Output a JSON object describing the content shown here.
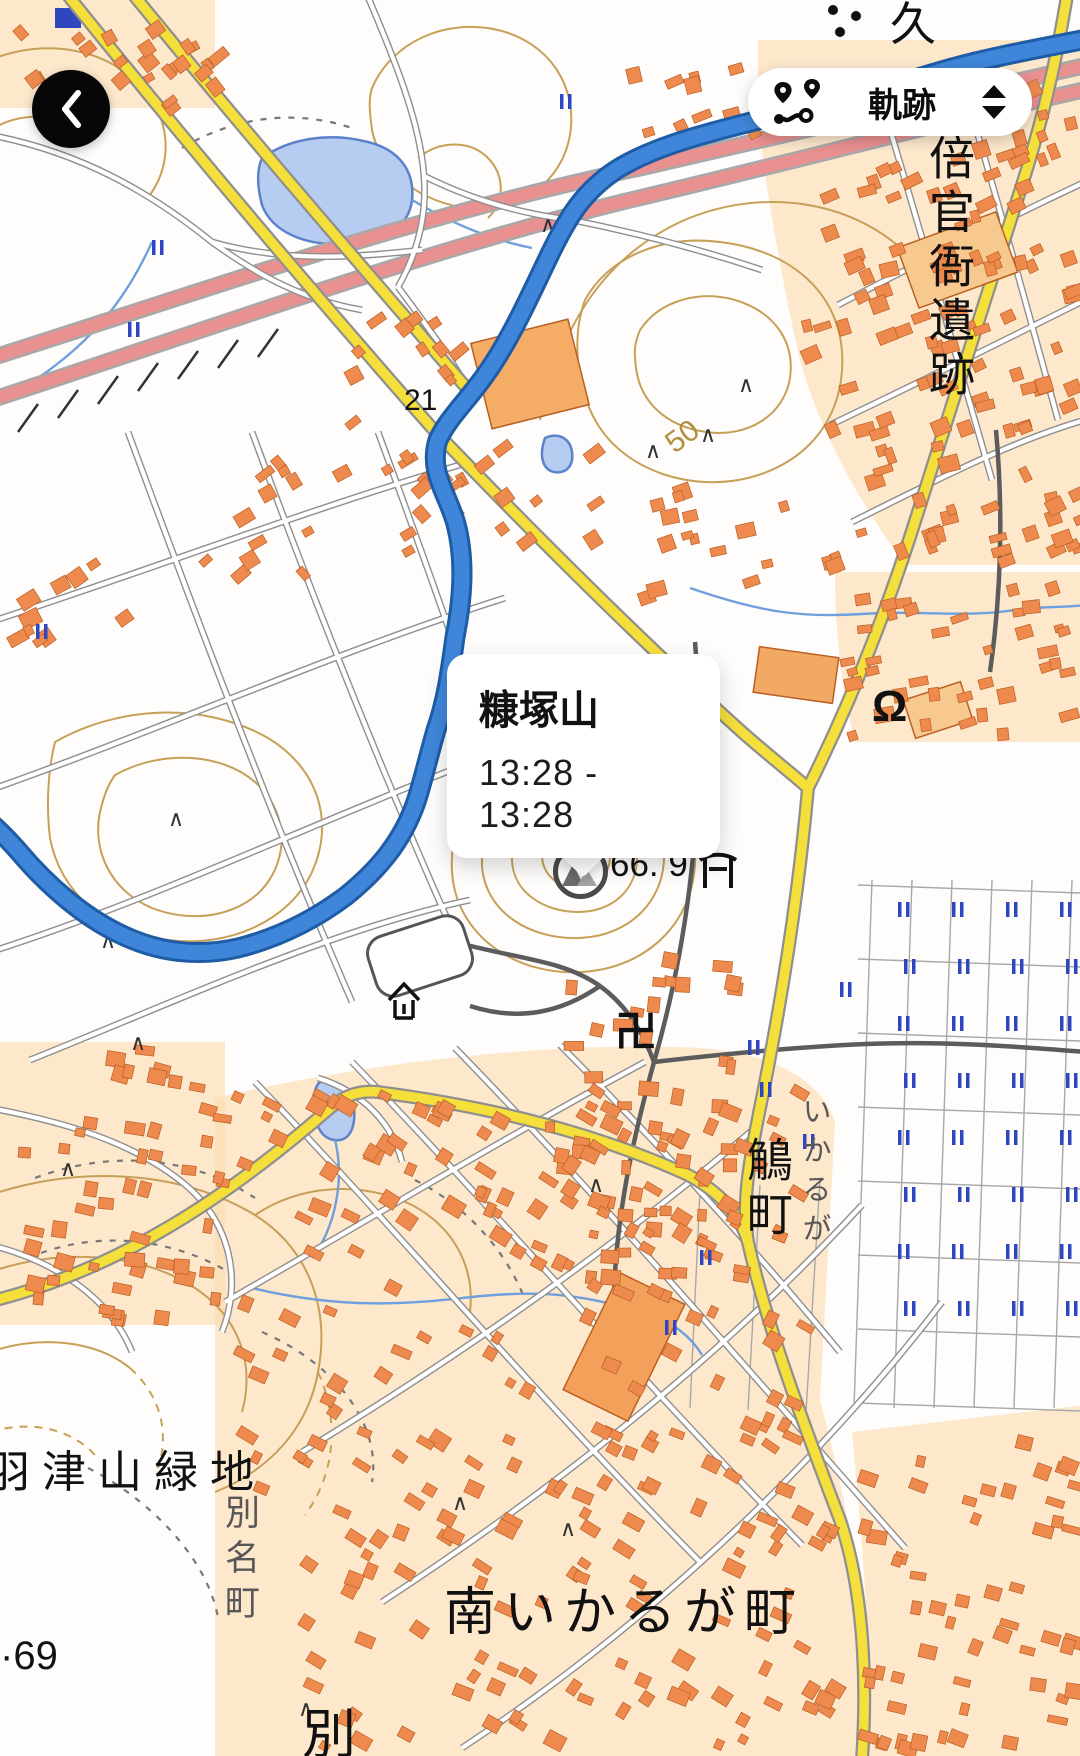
{
  "ui": {
    "back_button": {
      "icon": "chevron-left-icon"
    },
    "track_selector": {
      "label": "軌跡",
      "icon": "route-icon",
      "picker_icon": "up-down-triangles-icon"
    },
    "callout": {
      "title": "糠塚山",
      "time_range": "13:28 - 13:28"
    },
    "peak_marker": {
      "icon": "mountain-peak-icon",
      "elevation": "66. 9"
    }
  },
  "map_labels": {
    "ruins_site_vertical": "倍官衙遺跡",
    "contour_elevation": "50",
    "spot_elevation_21": "21",
    "spot_elevation_69": "·69",
    "ikaruga_town_vertical": "鵤町",
    "ikaruga_kana_vertical": "いかるが",
    "hazuyama_green_space": "羽津山緑地",
    "betsumyo_town_vertical": "別名町",
    "minami_ikaruga_town": "南いかるが町",
    "betsu_partial": "別",
    "ku_partial": "久",
    "temple_manji_symbol": "卍",
    "monument_symbol": "Ω"
  },
  "colors": {
    "track_blue": "#3f86da",
    "track_casing": "#1e5ca6",
    "road_yellow": "#f4df3b",
    "road_casing": "#8f8f8f",
    "highway_red": "#e99090",
    "building_orange": "#ef8a4e",
    "building_stroke": "#b95f23",
    "urban_tint": "#fbdcae",
    "contour": "#c7a058",
    "water_fill": "#b7ccf1",
    "water_stroke": "#5b82cb",
    "stream": "#6f9fdd",
    "paddy_blue": "#2e47c0",
    "dark_road": "#5c5c5c"
  }
}
